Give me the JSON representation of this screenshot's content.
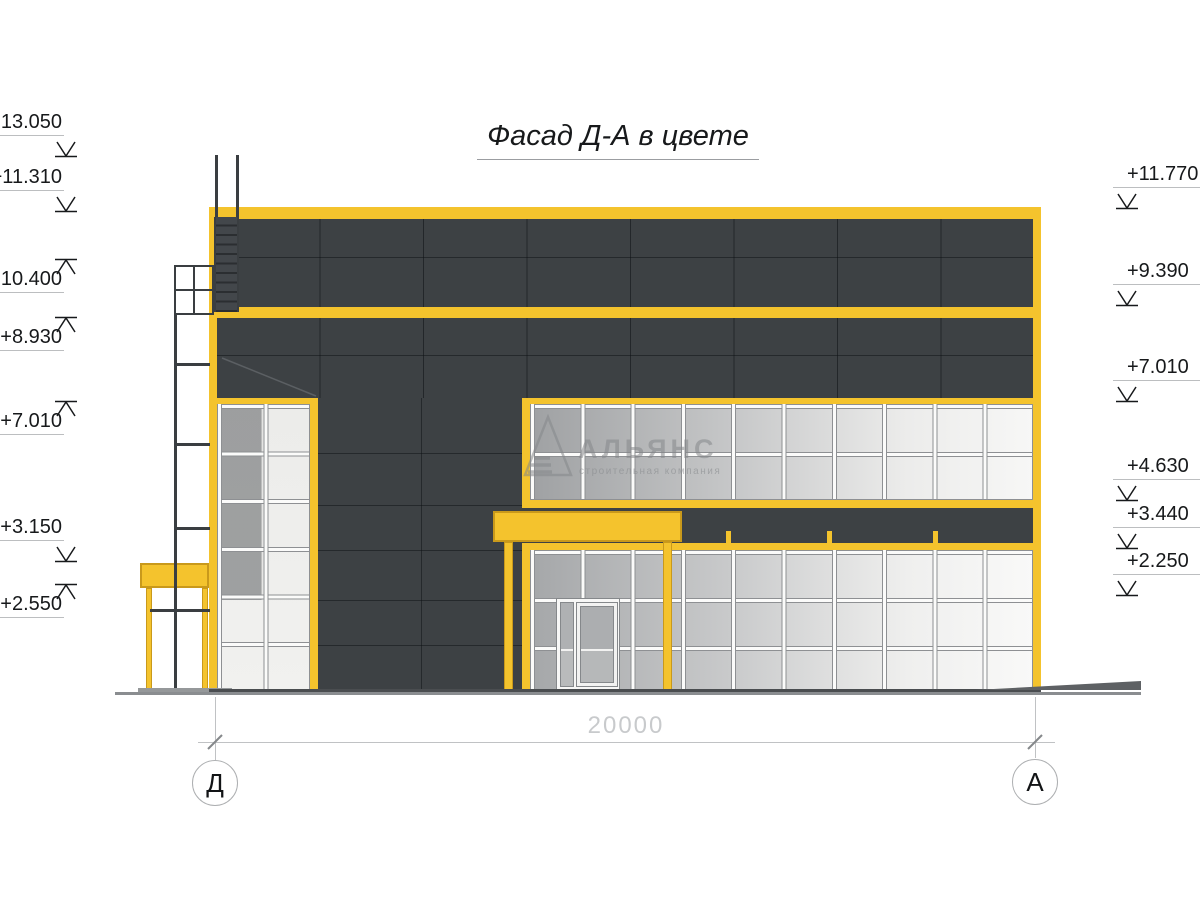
{
  "title": {
    "text": "Фасад Д-А в цвете"
  },
  "watermark": {
    "company": "АЛЬЯНС",
    "tagline": "строительная компания"
  },
  "levels": {
    "left": [
      {
        "value": "+13.050",
        "dir": "down"
      },
      {
        "value": "+11.310",
        "dir": "down"
      },
      {
        "value": "+10.400",
        "dir": "up"
      },
      {
        "value": "+8.930",
        "dir": "up"
      },
      {
        "value": "+7.010",
        "dir": "up"
      },
      {
        "value": "+3.150",
        "dir": "down"
      },
      {
        "value": "+2.550",
        "dir": "up"
      }
    ],
    "right": [
      {
        "value": "+11.770",
        "dir": "down"
      },
      {
        "value": "+9.390",
        "dir": "down"
      },
      {
        "value": "+7.010",
        "dir": "down"
      },
      {
        "value": "+4.630",
        "dir": "down"
      },
      {
        "value": "+3.440",
        "dir": "down"
      },
      {
        "value": "+2.250",
        "dir": "down"
      }
    ]
  },
  "dimension": {
    "total": "20000"
  },
  "axes": {
    "left": {
      "label": "Д"
    },
    "right": {
      "label": "А"
    }
  },
  "colors": {
    "accent_yellow": "#F4C32D",
    "facade_dark": "#3D4144"
  }
}
